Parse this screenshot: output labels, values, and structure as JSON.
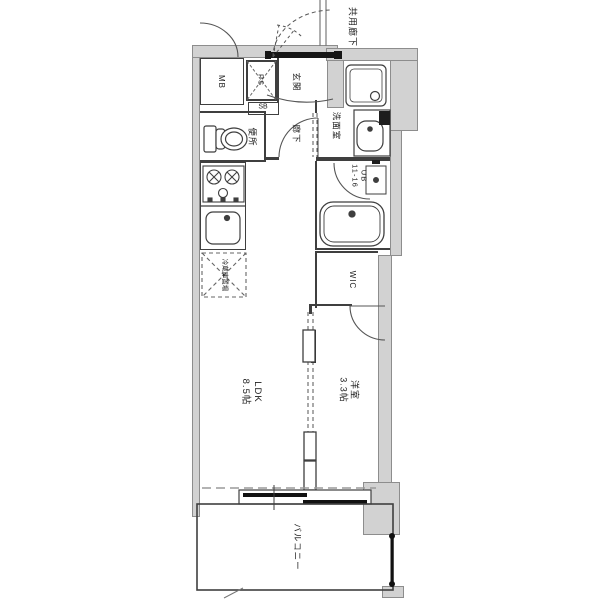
{
  "plan": {
    "type": "floor-plan",
    "colors": {
      "wall_fill": "#d2d2d2",
      "line": "#3f3f3f",
      "background": "#ffffff"
    },
    "labels": {
      "corridor": "共用廊下",
      "meter_box": "MB",
      "pipe_space": "PS",
      "shoe_box": "SB",
      "entrance": "玄関",
      "hallway": "廊下",
      "toilet": "便所",
      "washroom": "洗面室",
      "unit_bath": "UB\n11-16",
      "wic": "WIC",
      "fridge_space": "冷蔵庫置場",
      "ldk": "LDK\n8.5帖",
      "bedroom": "洋室\n3.3帖",
      "balcony": "バルコニー"
    }
  }
}
